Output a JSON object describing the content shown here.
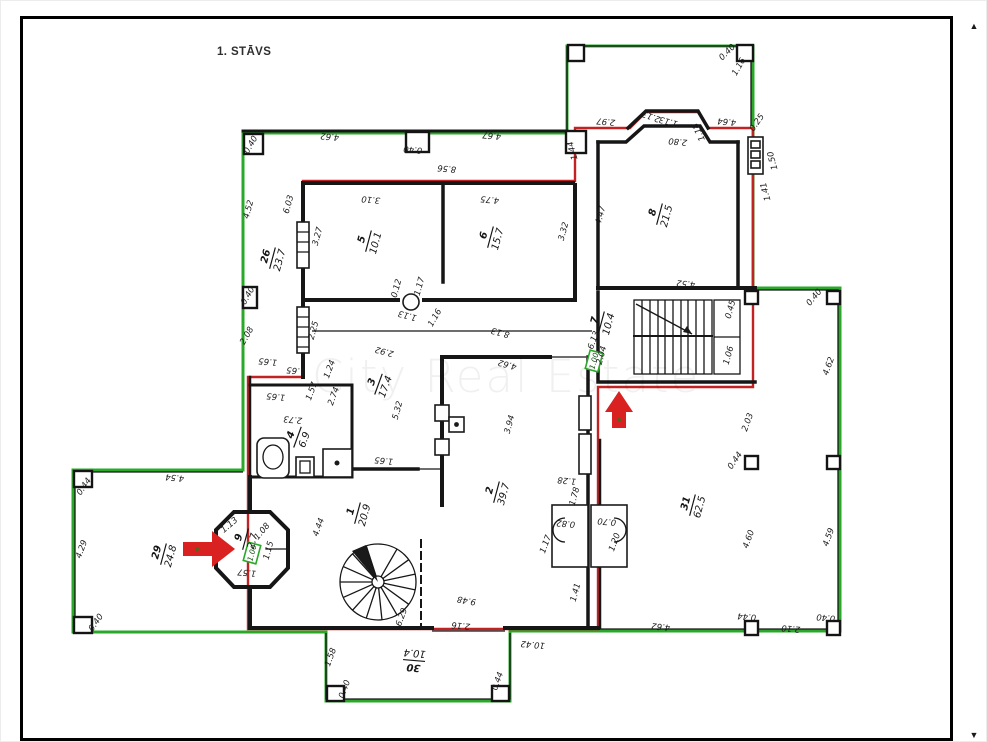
{
  "page": {
    "floor_title": "1. STĀVS",
    "watermark_text": "City Real Estate",
    "icons": {
      "scroll_up_icon": "▲",
      "scroll_down_icon": "▼"
    },
    "colors": {
      "wall_black": "#161616",
      "outline_green": "#2aa82a",
      "outline_red": "#c22222",
      "arrow_red": "#d92121",
      "watermark_gray": "#ebebeb",
      "paper_white": "#ffffff",
      "frame_black": "#000000"
    }
  },
  "plan": {
    "rooms": [
      {
        "number": "26",
        "area": "23.7",
        "x": 272,
        "y": 258,
        "r": -75
      },
      {
        "number": "5",
        "area": "10.1",
        "x": 368,
        "y": 241,
        "r": -75
      },
      {
        "number": "6",
        "area": "15.7",
        "x": 490,
        "y": 237,
        "r": -75
      },
      {
        "number": "8",
        "area": "21.5",
        "x": 659,
        "y": 214,
        "r": -75
      },
      {
        "number": "7",
        "area": "10.4",
        "x": 601,
        "y": 322,
        "r": -75
      },
      {
        "number": "3",
        "area": "17.4",
        "x": 378,
        "y": 384,
        "r": -70
      },
      {
        "number": "4",
        "area": "6.9",
        "x": 297,
        "y": 437,
        "r": -70
      },
      {
        "number": "2",
        "area": "39.7",
        "x": 496,
        "y": 492,
        "r": -75
      },
      {
        "number": "1",
        "area": "20.9",
        "x": 357,
        "y": 513,
        "r": -75
      },
      {
        "number": "31",
        "area": "62.5",
        "x": 692,
        "y": 505,
        "r": -75
      },
      {
        "number": "29",
        "area": "24.8",
        "x": 163,
        "y": 554,
        "r": -75
      },
      {
        "number": "9",
        "area": "2.7",
        "x": 245,
        "y": 539,
        "r": -75
      },
      {
        "number": "30",
        "area": "10.4",
        "x": 414,
        "y": 661,
        "r": 185
      }
    ],
    "measurements": [
      {
        "t": "4.62",
        "x": 330,
        "y": 134,
        "r": 185
      },
      {
        "t": "0.40",
        "x": 413,
        "y": 147,
        "r": 185
      },
      {
        "t": "4.67",
        "x": 492,
        "y": 133,
        "r": 185
      },
      {
        "t": "8.56",
        "x": 447,
        "y": 166,
        "r": 185
      },
      {
        "t": "1.44",
        "x": 575,
        "y": 150,
        "r": -105
      },
      {
        "t": "2.97",
        "x": 606,
        "y": 119,
        "r": 185
      },
      {
        "t": "2.13",
        "x": 652,
        "y": 114,
        "r": 200
      },
      {
        "t": "1.13",
        "x": 669,
        "y": 119,
        "r": 195
      },
      {
        "t": "2.80",
        "x": 678,
        "y": 139,
        "r": 185
      },
      {
        "t": "1.18",
        "x": 701,
        "y": 131,
        "r": -115
      },
      {
        "t": "4.64",
        "x": 727,
        "y": 119,
        "r": 185
      },
      {
        "t": "0.25",
        "x": 759,
        "y": 124,
        "r": -55
      },
      {
        "t": "0.40",
        "x": 729,
        "y": 54,
        "r": -45
      },
      {
        "t": "1.16",
        "x": 741,
        "y": 68,
        "r": -60
      },
      {
        "t": "1.50",
        "x": 775,
        "y": 160,
        "r": -105
      },
      {
        "t": "1.41",
        "x": 768,
        "y": 191,
        "r": -105
      },
      {
        "t": "0.40",
        "x": 253,
        "y": 146,
        "r": -60
      },
      {
        "t": "4.52",
        "x": 251,
        "y": 210,
        "r": -75
      },
      {
        "t": "6.03",
        "x": 291,
        "y": 205,
        "r": -75
      },
      {
        "t": "0.40",
        "x": 250,
        "y": 297,
        "r": -60
      },
      {
        "t": "2.08",
        "x": 249,
        "y": 337,
        "r": -60
      },
      {
        "t": "1.65",
        "x": 268,
        "y": 359,
        "r": 185
      },
      {
        "t": "3.10",
        "x": 371,
        "y": 197,
        "r": 185
      },
      {
        "t": "4.75",
        "x": 490,
        "y": 197,
        "r": 185
      },
      {
        "t": "3.27",
        "x": 320,
        "y": 237,
        "r": -75
      },
      {
        "t": "3.32",
        "x": 566,
        "y": 232,
        "r": -75
      },
      {
        "t": "4.47",
        "x": 603,
        "y": 216,
        "r": -75
      },
      {
        "t": "4.52",
        "x": 686,
        "y": 281,
        "r": 185
      },
      {
        "t": "0.12",
        "x": 399,
        "y": 289,
        "r": -75
      },
      {
        "t": "1.17",
        "x": 422,
        "y": 287,
        "r": -75
      },
      {
        "t": "2.25",
        "x": 316,
        "y": 331,
        "r": -75
      },
      {
        "t": "2.92",
        "x": 385,
        "y": 349,
        "r": 195
      },
      {
        "t": "1.13",
        "x": 408,
        "y": 313,
        "r": 195
      },
      {
        "t": "1.16",
        "x": 437,
        "y": 319,
        "r": -60
      },
      {
        "t": "8.13",
        "x": 501,
        "y": 330,
        "r": 195
      },
      {
        "t": "4.62",
        "x": 508,
        "y": 362,
        "r": 195
      },
      {
        "t": "2.04",
        "x": 604,
        "y": 356,
        "r": -75
      },
      {
        "t": "6.13",
        "x": 596,
        "y": 341,
        "r": -70
      },
      {
        "t": "0.45",
        "x": 733,
        "y": 310,
        "r": -75
      },
      {
        "t": "1.06",
        "x": 731,
        "y": 356,
        "r": -75
      },
      {
        "t": "1.65",
        "x": 296,
        "y": 368,
        "r": 185
      },
      {
        "t": "1.24",
        "x": 332,
        "y": 370,
        "r": -70
      },
      {
        "t": "1.57",
        "x": 314,
        "y": 392,
        "r": -70
      },
      {
        "t": "2.74",
        "x": 336,
        "y": 397,
        "r": -70
      },
      {
        "t": "1.65",
        "x": 276,
        "y": 394,
        "r": 185
      },
      {
        "t": "2.73",
        "x": 293,
        "y": 417,
        "r": 185
      },
      {
        "t": "5.32",
        "x": 400,
        "y": 411,
        "r": -75
      },
      {
        "t": "1.65",
        "x": 384,
        "y": 458,
        "r": 185
      },
      {
        "t": "3.94",
        "x": 512,
        "y": 425,
        "r": -75
      },
      {
        "t": "4.44",
        "x": 321,
        "y": 528,
        "r": -70
      },
      {
        "t": "9.48",
        "x": 467,
        "y": 598,
        "r": 190
      },
      {
        "t": "2.16",
        "x": 461,
        "y": 623,
        "r": 185
      },
      {
        "t": "6.29",
        "x": 404,
        "y": 618,
        "r": -70
      },
      {
        "t": "4.54",
        "x": 175,
        "y": 475,
        "r": 185
      },
      {
        "t": "4.29",
        "x": 84,
        "y": 550,
        "r": -70
      },
      {
        "t": "0.44",
        "x": 86,
        "y": 488,
        "r": -55
      },
      {
        "t": "0.40",
        "x": 98,
        "y": 624,
        "r": -55
      },
      {
        "t": "1.13",
        "x": 231,
        "y": 527,
        "r": -40
      },
      {
        "t": "1.08",
        "x": 264,
        "y": 533,
        "r": -50
      },
      {
        "t": "1.15",
        "x": 271,
        "y": 551,
        "r": -75
      },
      {
        "t": "1.57",
        "x": 247,
        "y": 570,
        "r": 185
      },
      {
        "t": "1.58",
        "x": 333,
        "y": 658,
        "r": -70
      },
      {
        "t": "0.40",
        "x": 347,
        "y": 690,
        "r": -70
      },
      {
        "t": "0.44",
        "x": 500,
        "y": 682,
        "r": -70
      },
      {
        "t": "10.42",
        "x": 533,
        "y": 642,
        "r": 185
      },
      {
        "t": "1.41",
        "x": 578,
        "y": 593,
        "r": -75
      },
      {
        "t": "1.28",
        "x": 567,
        "y": 478,
        "r": 185
      },
      {
        "t": "1.78",
        "x": 577,
        "y": 497,
        "r": -75
      },
      {
        "t": "0.82",
        "x": 566,
        "y": 521,
        "r": 185
      },
      {
        "t": "0.70",
        "x": 607,
        "y": 519,
        "r": 185
      },
      {
        "t": "1.17",
        "x": 548,
        "y": 545,
        "r": -70
      },
      {
        "t": "1.20",
        "x": 617,
        "y": 543,
        "r": -70
      },
      {
        "t": "4.62",
        "x": 661,
        "y": 624,
        "r": 185
      },
      {
        "t": "0.40",
        "x": 816,
        "y": 299,
        "r": -50
      },
      {
        "t": "4.62",
        "x": 831,
        "y": 367,
        "r": -70
      },
      {
        "t": "2.03",
        "x": 750,
        "y": 423,
        "r": -70
      },
      {
        "t": "0.44",
        "x": 737,
        "y": 462,
        "r": -55
      },
      {
        "t": "4.60",
        "x": 751,
        "y": 540,
        "r": -70
      },
      {
        "t": "4.59",
        "x": 831,
        "y": 538,
        "r": -70
      },
      {
        "t": "0.44",
        "x": 747,
        "y": 614,
        "r": 185
      },
      {
        "t": "2.10",
        "x": 791,
        "y": 626,
        "r": 185
      },
      {
        "t": "0.40",
        "x": 826,
        "y": 615,
        "r": 185
      }
    ],
    "green_tags": [
      {
        "t": "1.00",
        "x": 594,
        "y": 361,
        "r": -75
      },
      {
        "t": "1.00",
        "x": 252,
        "y": 553,
        "r": -75
      }
    ]
  }
}
